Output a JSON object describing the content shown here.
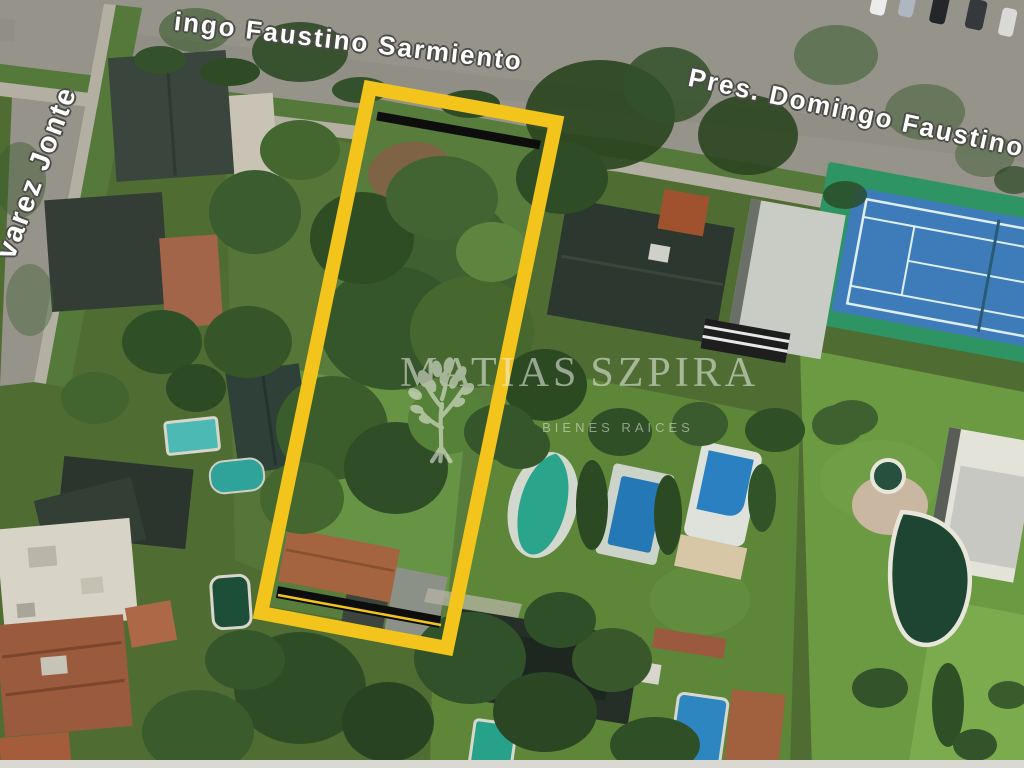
{
  "image": {
    "description": "Aerial satellite photo of a residential block with a vacant lot highlighted for sale",
    "width_px": 1024,
    "height_px": 768
  },
  "streets": {
    "top_label": "ingo Faustino Sarmiento",
    "right_label": "Pres. Domingo Faustino Sa",
    "left_label": "varez Jonte",
    "label_color": "#ffffff",
    "label_outline_color": "#4c4c47",
    "pavement_color": "#96938a"
  },
  "lot": {
    "points": "370,88 556,122 447,648 261,613",
    "outline_color": "#F2C41C",
    "inner_stripe_color": "#0d0d0d"
  },
  "watermark": {
    "brand_left": "MATIAS",
    "brand_right": "SZPIRA",
    "tagline": "BIENES RAICES",
    "logo": "tree-icon",
    "color": "#f2f2ec"
  },
  "features": {
    "tennis_court": {
      "surface_color": "#3e7cb9",
      "surround_color": "#2f9464",
      "line_color": "#dfeef2"
    },
    "pools": {
      "blue": "#2b80c2",
      "teal": "#2aa58c",
      "turquoise": "#4cb9b4",
      "dark_green": "#1d4531"
    },
    "lawn_color": "#5d8639",
    "roof_dark_color": "#2c372f",
    "roof_terracotta_color": "#9a5a3e"
  }
}
